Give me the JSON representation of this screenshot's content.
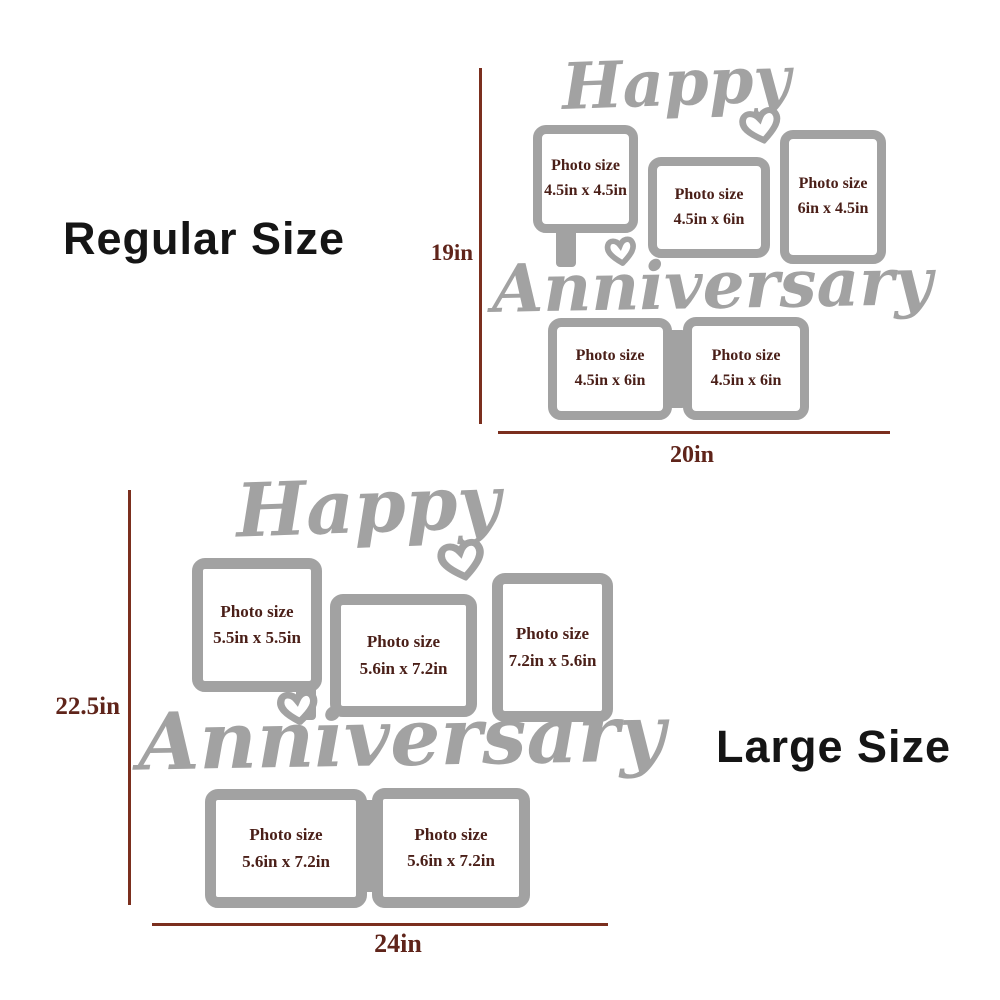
{
  "colors": {
    "frame_gray": "#a2a2a2",
    "photo_text": "#4a1f18",
    "dim_line": "#7b2f1e",
    "dim_text": "#5f241a",
    "label_text": "#151515",
    "background": "#ffffff"
  },
  "icons": {
    "heart": "heart-icon"
  },
  "regular": {
    "label": "Regular Size",
    "height_label": "19in",
    "width_label": "20in",
    "word_top": "Happy",
    "word_bottom": "Anniversary",
    "frames": [
      {
        "line1": "Photo size",
        "line2": "4.5in x 4.5in"
      },
      {
        "line1": "Photo size",
        "line2": "4.5in x 6in"
      },
      {
        "line1": "Photo size",
        "line2": "6in x 4.5in"
      },
      {
        "line1": "Photo size",
        "line2": "4.5in x 6in"
      },
      {
        "line1": "Photo size",
        "line2": "4.5in x 6in"
      }
    ]
  },
  "large": {
    "label": "Large Size",
    "height_label": "22.5in",
    "width_label": "24in",
    "word_top": "Happy",
    "word_bottom": "Anniversary",
    "frames": [
      {
        "line1": "Photo size",
        "line2": "5.5in x 5.5in"
      },
      {
        "line1": "Photo size",
        "line2": "5.6in x 7.2in"
      },
      {
        "line1": "Photo size",
        "line2": "7.2in x 5.6in"
      },
      {
        "line1": "Photo size",
        "line2": "5.6in x 7.2in"
      },
      {
        "line1": "Photo size",
        "line2": "5.6in x 7.2in"
      }
    ]
  }
}
